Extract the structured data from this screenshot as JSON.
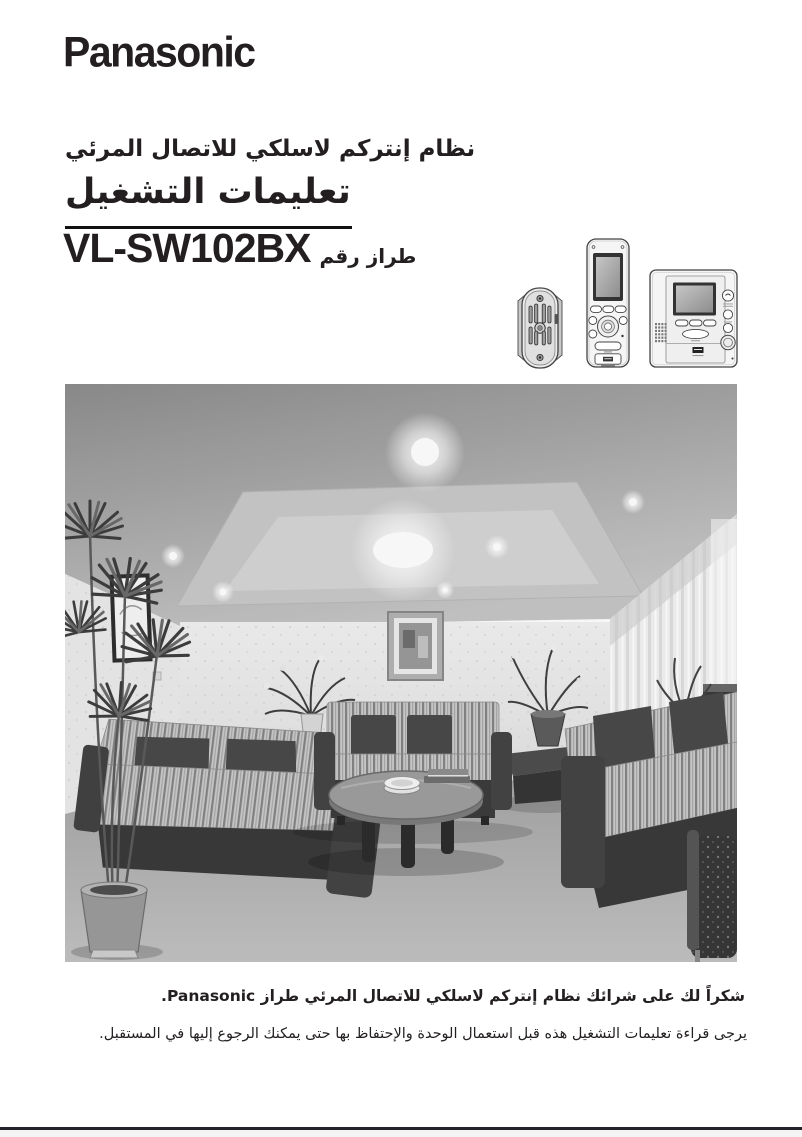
{
  "brand": "Panasonic",
  "header": {
    "system_title": "نظام إنتركم لاسلكي للاتصال المرئي",
    "doc_title": "تعليمات التشغيل",
    "model_label": "طراز رقم",
    "model_number": "VL-SW102BX"
  },
  "devices": {
    "door_station": "door-station",
    "wireless_handset": "wireless-monitor-handset",
    "main_monitor": "main-monitor-station"
  },
  "photo": {
    "description": "grayscale living room photograph with three striped sofas, round coffee table, potted plants, framed pictures and curtains"
  },
  "footer": {
    "thanks": "شكراً لك على شرائك نظام إنتركم لاسلكي للاتصال المرئي طراز Panasonic.",
    "note": "يرجى قراءة تعليمات التشغيل هذه قبل استعمال الوحدة والإحتفاظ بها حتى يمكنك الرجوع إليها في المستقبل."
  },
  "colors": {
    "ink": "#231f20",
    "paper": "#ffffff"
  }
}
